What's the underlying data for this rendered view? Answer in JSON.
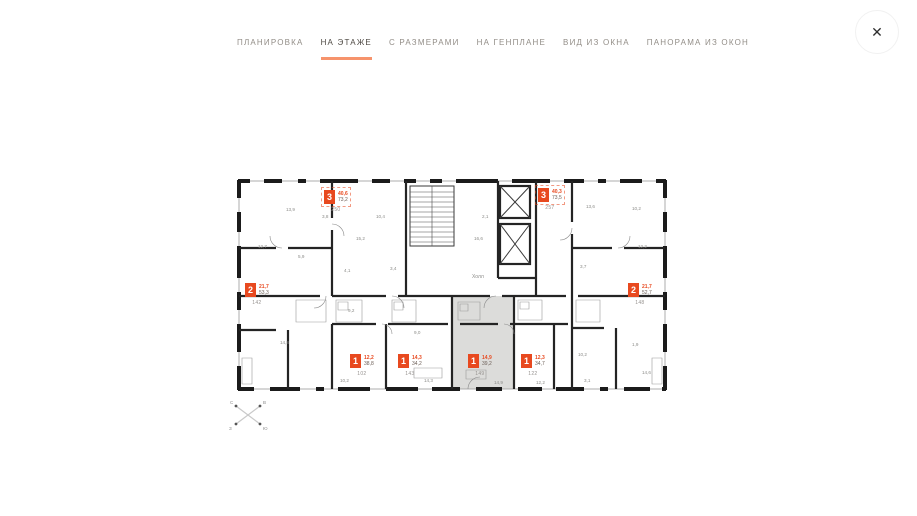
{
  "header": {
    "tabs": [
      {
        "id": "planirovka",
        "label": "ПЛАНИРОВКА",
        "active": false
      },
      {
        "id": "na-etazhe",
        "label": "НА ЭТАЖЕ",
        "active": true
      },
      {
        "id": "s-razmerami",
        "label": "С РАЗМЕРАМИ",
        "active": false
      },
      {
        "id": "na-genplane",
        "label": "НА ГЕНПЛАНЕ",
        "active": false
      },
      {
        "id": "vid-iz-okna",
        "label": "ВИД ИЗ ОКНА",
        "active": false
      },
      {
        "id": "panorama-iz-okon",
        "label": "ПАНОРАМА ИЗ ОКОН",
        "active": false
      }
    ],
    "close_label": "✕"
  },
  "colors": {
    "accent": "#e8491f",
    "tab_underline": "#f6936c",
    "wall": "#1b1b1b",
    "selected_fill": "#dcdcda"
  },
  "plan": {
    "hall_label": "Холл",
    "compass": {
      "n": "С",
      "e": "В",
      "s": "Ю",
      "w": "З"
    },
    "badges": [
      {
        "rooms": "3",
        "area1": "40,6",
        "area2": "73,2",
        "unit": "250",
        "x": 88,
        "y": 12,
        "dashed": true,
        "selected": false
      },
      {
        "rooms": "3",
        "area1": "40,3",
        "area2": "73,5",
        "unit": "257",
        "x": 302,
        "y": 10,
        "dashed": true,
        "selected": false
      },
      {
        "rooms": "2",
        "area1": "21,7",
        "area2": "53,3",
        "unit": "142",
        "x": 9,
        "y": 105,
        "dashed": false,
        "selected": false
      },
      {
        "rooms": "2",
        "area1": "21,7",
        "area2": "52,7",
        "unit": "148",
        "x": 392,
        "y": 105,
        "dashed": false,
        "selected": false
      },
      {
        "rooms": "1",
        "area1": "12,2",
        "area2": "38,8",
        "unit": "102",
        "x": 114,
        "y": 176,
        "dashed": false,
        "selected": false
      },
      {
        "rooms": "1",
        "area1": "14,3",
        "area2": "34,2",
        "unit": "143",
        "x": 162,
        "y": 176,
        "dashed": false,
        "selected": false
      },
      {
        "rooms": "1",
        "area1": "14,9",
        "area2": "39,2",
        "unit": "149",
        "x": 232,
        "y": 176,
        "dashed": false,
        "selected": true
      },
      {
        "rooms": "1",
        "area1": "12,3",
        "area2": "34,7",
        "unit": "122",
        "x": 285,
        "y": 176,
        "dashed": false,
        "selected": false
      }
    ],
    "room_labels": [
      {
        "t": "13,9",
        "x": 50,
        "y": 33
      },
      {
        "t": "3,8",
        "x": 86,
        "y": 40
      },
      {
        "t": "12,7",
        "x": 22,
        "y": 70
      },
      {
        "t": "5,9",
        "x": 62,
        "y": 80
      },
      {
        "t": "15,2",
        "x": 120,
        "y": 62
      },
      {
        "t": "4,1",
        "x": 108,
        "y": 94
      },
      {
        "t": "10,4",
        "x": 140,
        "y": 40
      },
      {
        "t": "3,4",
        "x": 154,
        "y": 92
      },
      {
        "t": "16,6",
        "x": 238,
        "y": 62
      },
      {
        "t": "2,1",
        "x": 246,
        "y": 40
      },
      {
        "t": "13,6",
        "x": 350,
        "y": 30
      },
      {
        "t": "10,2",
        "x": 396,
        "y": 32
      },
      {
        "t": "12,2",
        "x": 402,
        "y": 70
      },
      {
        "t": "3,7",
        "x": 344,
        "y": 90
      },
      {
        "t": "14,8",
        "x": 44,
        "y": 166
      },
      {
        "t": "9,2",
        "x": 112,
        "y": 134
      },
      {
        "t": "10,2",
        "x": 104,
        "y": 204
      },
      {
        "t": "14,3",
        "x": 188,
        "y": 204
      },
      {
        "t": "9,0",
        "x": 178,
        "y": 156
      },
      {
        "t": "14,9",
        "x": 258,
        "y": 206
      },
      {
        "t": "12,2",
        "x": 300,
        "y": 206
      },
      {
        "t": "10,2",
        "x": 342,
        "y": 178
      },
      {
        "t": "3,1",
        "x": 348,
        "y": 204
      },
      {
        "t": "1,9",
        "x": 396,
        "y": 168
      },
      {
        "t": "14,6",
        "x": 406,
        "y": 196
      }
    ]
  }
}
